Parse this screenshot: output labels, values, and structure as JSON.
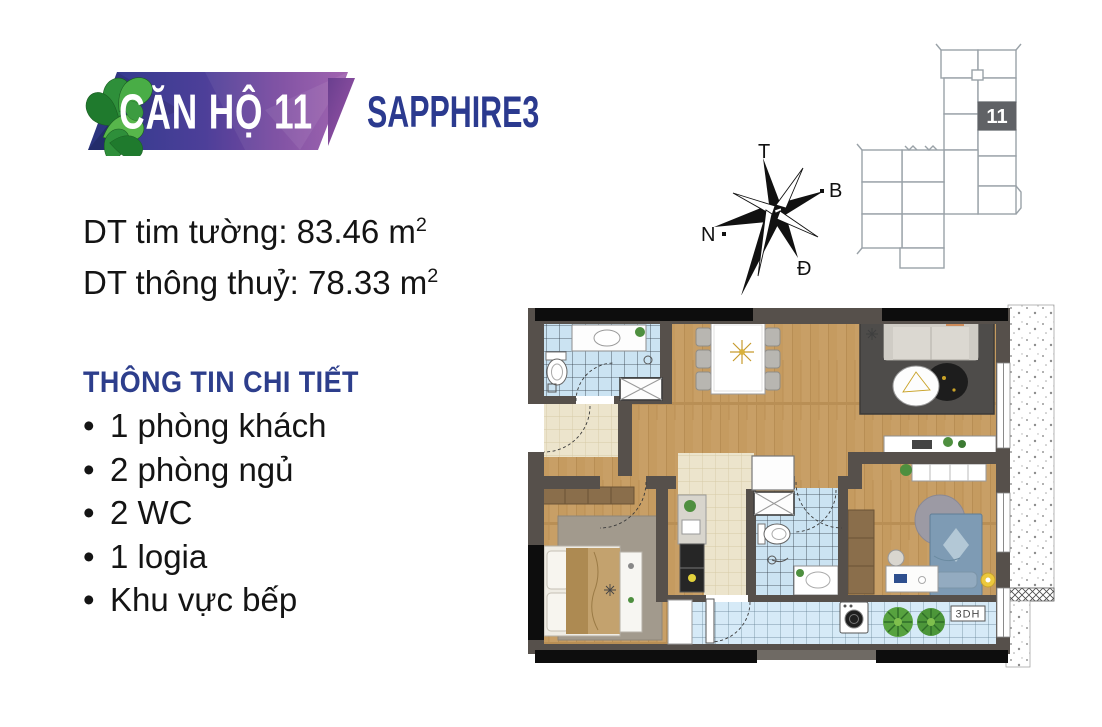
{
  "banner": {
    "title": "CĂN HỘ 11",
    "subtitle": "SAPPHIRE3"
  },
  "areas": {
    "line1": {
      "label": "DT tim tường: 83.46 m",
      "sup": "2"
    },
    "line2": {
      "label": "DT thông thuỷ: 78.33 m",
      "sup": "2"
    }
  },
  "details": {
    "heading": "THÔNG TIN CHI TIẾT",
    "items": [
      "1 phòng khách",
      "2 phòng ngủ",
      "2 WC",
      "1 logia",
      "Khu vực bếp"
    ]
  },
  "compass": {
    "top": "T",
    "upper_right": "B",
    "left": "N",
    "lower_right": "Đ"
  },
  "key_plan": {
    "unit_label": "11"
  },
  "floor_plan": {
    "viewer_label": "3DH"
  },
  "palette": {
    "heading_blue": "#2d3e8c",
    "subtitle_navy": "#2b3a8f",
    "banner_indigo": "#2e3a8c",
    "banner_purple": "#9c5bab",
    "leaf_green": "#2f8f3a",
    "text_black": "#161616",
    "wall_gray": "#56504b",
    "wood_floor": "#c89f66",
    "tile_blue": "#cbe3f2",
    "tile_cream": "#ece4cc",
    "tile_logia": "#d6eaf7",
    "band_black": "#0d0d0d",
    "unit_highlight": "#606266"
  }
}
